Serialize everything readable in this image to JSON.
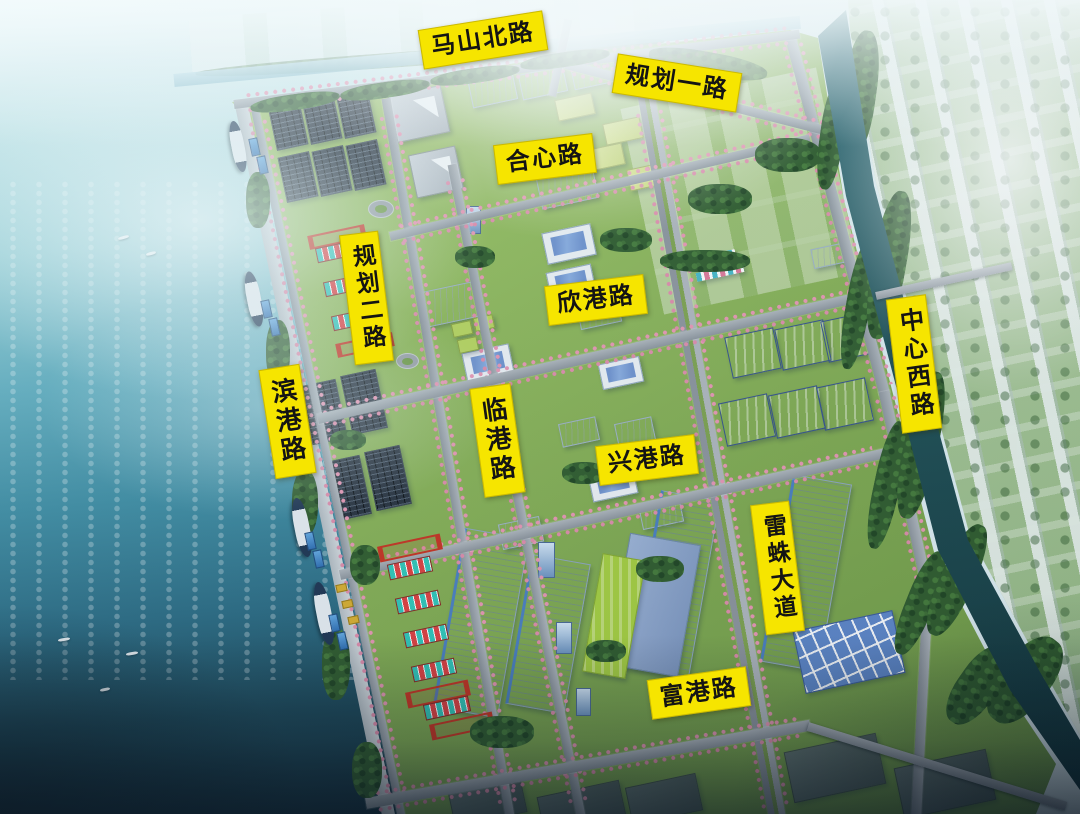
{
  "road_labels": [
    {
      "id": "mashan-north-road",
      "text": "马山北路",
      "orientation": "horizontal"
    },
    {
      "id": "guihua-road-1",
      "text": "规划一路",
      "orientation": "horizontal"
    },
    {
      "id": "hexin-road",
      "text": "合心路",
      "orientation": "horizontal"
    },
    {
      "id": "guihua-road-2",
      "text": "规划二路",
      "orientation": "vertical"
    },
    {
      "id": "xingang-road",
      "text": "欣港路",
      "orientation": "horizontal"
    },
    {
      "id": "zhongxin-west-road",
      "text": "中心西路",
      "orientation": "vertical"
    },
    {
      "id": "bingang-road",
      "text": "滨港路",
      "orientation": "vertical"
    },
    {
      "id": "lingang-road",
      "text": "临港路",
      "orientation": "vertical"
    },
    {
      "id": "xinggang-road",
      "text": "兴港路",
      "orientation": "horizontal"
    },
    {
      "id": "leizhu-avenue",
      "text": "雷蛛大道",
      "orientation": "vertical"
    },
    {
      "id": "fugang-road",
      "text": "富港路",
      "orientation": "horizontal"
    }
  ],
  "colors": {
    "label_background": "#F6E500",
    "label_text": "#141414",
    "sea_shallow": "#BFE6EA",
    "sea_deep": "#12303F",
    "land_green": "#8AB458",
    "tree_green": "#2F5B2B",
    "road_gray": "#9AA0A6",
    "blossom_pink": "#E890AC",
    "river_teal": "#1D4D52",
    "warehouse_white": "#EDF1F5",
    "roof_blue": "#5B82C6",
    "solar_panel_dark": "#28313D",
    "container_teal": "#2FC7B9",
    "container_red": "#E03E3E",
    "gantry_crane_red": "#C8321F",
    "distant_building_white": "#E9EFF3"
  }
}
